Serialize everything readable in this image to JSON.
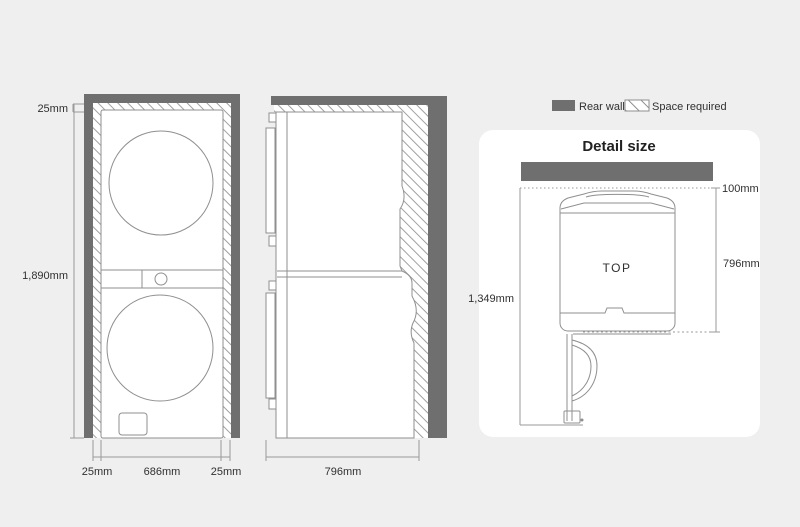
{
  "page": {
    "background": "#efefef"
  },
  "colors": {
    "rear_wall": "#6f6f6f",
    "outline": "#8f8f8f",
    "dimension_line": "#9a9a9a",
    "text": "#303030",
    "card_background": "#ffffff"
  },
  "legend": {
    "rear_wall": "Rear wall",
    "space_required": "Space required"
  },
  "front_view": {
    "top_clearance": "25mm",
    "total_height": "1,890mm",
    "bottom_left_clearance": "25mm",
    "unit_width": "686mm",
    "bottom_right_clearance": "25mm"
  },
  "side_view": {
    "unit_depth": "796mm"
  },
  "detail_card": {
    "title": "Detail size",
    "view_label": "TOP",
    "rear_clearance": "100mm",
    "unit_depth": "796mm",
    "depth_door_open": "1,349mm"
  }
}
